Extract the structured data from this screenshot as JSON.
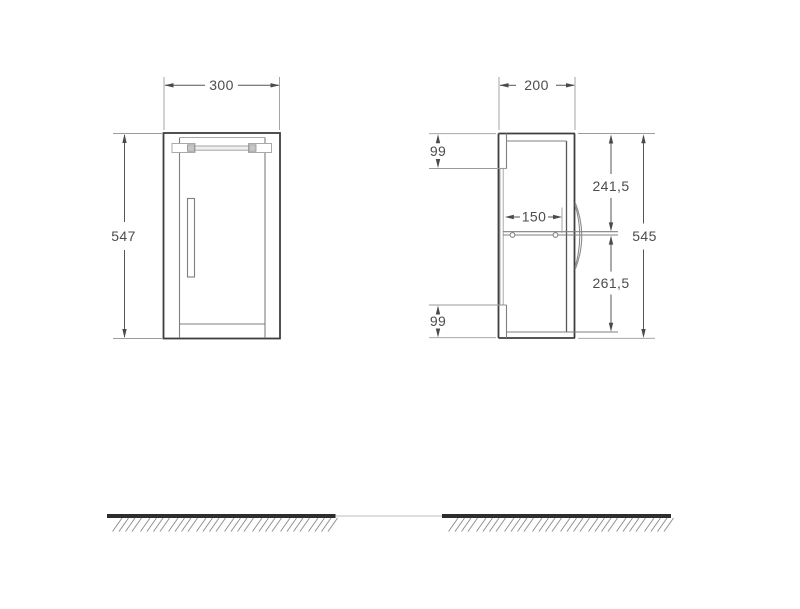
{
  "drawing_type": "wall-hung bathroom cabinet technical drawing, front and side views with dimensions",
  "front_view": {
    "width": "300",
    "height": "547"
  },
  "side_view": {
    "depth": "200",
    "top_offset": "99",
    "upper_height": "241,5",
    "shelf_depth": "150",
    "lower_height": "261,5",
    "bottom_offset": "99",
    "total_height": "545"
  },
  "colors": {
    "background": "#ffffff",
    "outline": "#3e3e3e",
    "secondary_line": "#7f7f7f",
    "extension_line": "#9b9b9b",
    "dimension_text": "#4d4d4d",
    "ground_line": "#2d2d2d",
    "hatch": "#8a8a8a"
  }
}
